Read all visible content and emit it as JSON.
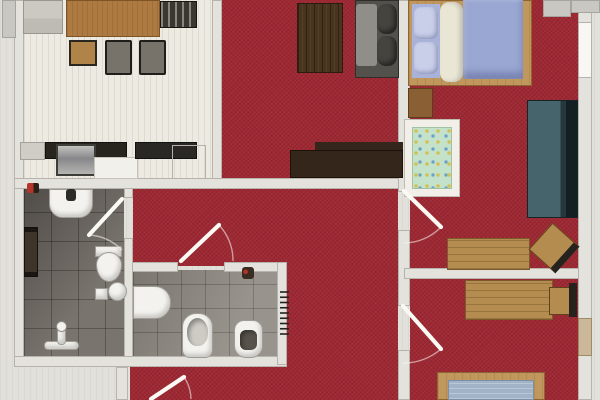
{
  "title": "apartment-floor-plan",
  "palette": {
    "carpet_red": "#9d2732",
    "floor_light": "#edeae2",
    "tile_dark": "#6f6963",
    "tile_light": "#8f8a82",
    "wall": "#e4e2dd",
    "wood": "#b58c50",
    "wood_dark": "#49341d",
    "sideboard_brown": "#34261a",
    "lavender": "#9aa7d3",
    "teal_bed": "#46646c",
    "crib_mint": "#c4e2c9",
    "mattress_blue": "#a2b3c7",
    "fixture_white": "#f3f2ee",
    "door_leaf": "#fbf9f4",
    "radiator_black": "#23211c"
  },
  "elements": [
    {
      "n": "dining-kitchen-floor",
      "c": "floor-light",
      "x": 24,
      "y": 0,
      "w": 188,
      "h": 182
    },
    {
      "n": "living-room-floor",
      "c": "carpet",
      "x": 222,
      "y": 0,
      "w": 176,
      "h": 180
    },
    {
      "n": "bedroom1-floor",
      "c": "carpet",
      "x": 410,
      "y": 0,
      "w": 168,
      "h": 272
    },
    {
      "n": "bedroom2-floor",
      "c": "carpet",
      "x": 410,
      "y": 278,
      "w": 168,
      "h": 122
    },
    {
      "n": "hallway-floor-top",
      "c": "carpet",
      "x": 133,
      "y": 188,
      "w": 265,
      "h": 78
    },
    {
      "n": "hallway-floor-right",
      "c": "carpet",
      "x": 287,
      "y": 264,
      "w": 111,
      "h": 136
    },
    {
      "n": "hallway-floor-bottom",
      "c": "carpet",
      "x": 130,
      "y": 362,
      "w": 157,
      "h": 38
    },
    {
      "n": "bathroom-floor",
      "c": "tile-dark",
      "x": 24,
      "y": 188,
      "w": 100,
      "h": 170
    },
    {
      "n": "wc-floor",
      "c": "tile-light",
      "x": 133,
      "y": 270,
      "w": 144,
      "h": 87
    },
    {
      "n": "left-exterior-wall",
      "c": "wall",
      "x": 14,
      "y": 0,
      "w": 10,
      "h": 358
    },
    {
      "n": "dining-living-wall",
      "c": "wall",
      "x": 212,
      "y": 0,
      "w": 10,
      "h": 188
    },
    {
      "n": "south-wall-band",
      "c": "wall",
      "x": 14,
      "y": 178,
      "w": 390,
      "h": 11
    },
    {
      "n": "living-bedroom1-wall",
      "c": "wall",
      "x": 398,
      "y": 0,
      "w": 12,
      "h": 192
    },
    {
      "n": "hallway-east-wall-mid",
      "c": "wall",
      "x": 398,
      "y": 230,
      "w": 12,
      "h": 76
    },
    {
      "n": "hallway-east-wall-low",
      "c": "wall",
      "x": 398,
      "y": 350,
      "w": 12,
      "h": 50
    },
    {
      "n": "bedroom-divider-wall",
      "c": "wall",
      "x": 404,
      "y": 268,
      "w": 188,
      "h": 11
    },
    {
      "n": "wc-north-wall-left",
      "c": "wall",
      "x": 124,
      "y": 262,
      "w": 54,
      "h": 10
    },
    {
      "n": "wc-north-wall-right",
      "c": "wall",
      "x": 224,
      "y": 262,
      "w": 63,
      "h": 10
    },
    {
      "n": "bathroom-east-wall-top",
      "c": "wall",
      "x": 124,
      "y": 188,
      "w": 9,
      "h": 10
    },
    {
      "n": "bathroom-east-wall-low",
      "c": "wall",
      "x": 124,
      "y": 238,
      "w": 9,
      "h": 119
    },
    {
      "n": "bath-wc-south-wall",
      "c": "wall",
      "x": 14,
      "y": 356,
      "w": 273,
      "h": 11
    },
    {
      "n": "entrance-wall",
      "c": "wall",
      "x": 116,
      "y": 367,
      "w": 12,
      "h": 33
    },
    {
      "n": "wc-east-wall",
      "c": "wall",
      "x": 277,
      "y": 262,
      "w": 10,
      "h": 103
    },
    {
      "n": "right-exterior-wall",
      "c": "wall",
      "x": 578,
      "y": 0,
      "w": 14,
      "h": 400
    },
    {
      "n": "right-wall-window",
      "c": "wall-window",
      "x": 578,
      "y": 22,
      "w": 14,
      "h": 56
    },
    {
      "n": "right-wall-wood-door",
      "c": "",
      "x": 578,
      "y": 318,
      "w": 14,
      "h": 38,
      "s": "background:#cbb89a;border:1px solid #a08a64;"
    },
    {
      "n": "balcony-slab-a",
      "c": "slab",
      "x": 543,
      "y": 0,
      "w": 28,
      "h": 17
    },
    {
      "n": "balcony-slab-b",
      "c": "slab",
      "x": 571,
      "y": 0,
      "w": 29,
      "h": 13
    },
    {
      "n": "left-edge-pillar",
      "c": "slab",
      "x": 2,
      "y": 0,
      "w": 14,
      "h": 38
    },
    {
      "n": "gray-cabinet",
      "c": "",
      "x": 23,
      "y": 0,
      "w": 40,
      "h": 34,
      "s": "background:linear-gradient(180deg,#cbc9c2 0 55%,#bdbbb4 55% 100%);border:1px solid #98968f;"
    },
    {
      "n": "dining-table",
      "c": "",
      "x": 66,
      "y": 0,
      "w": 94,
      "h": 37,
      "s": "background-color:#ad7a42;background-image:repeating-linear-gradient(90deg,rgba(120,75,25,.25) 0 1px,transparent 1px 5px);border:1px solid #7e5426;"
    },
    {
      "n": "dining-chair-top",
      "c": "",
      "x": 160,
      "y": 1,
      "w": 37,
      "h": 27,
      "s": "background-color:#3a3731;background-image:repeating-linear-gradient(90deg,rgba(230,228,220,.45) 0 2px,transparent 2px 7px);border:1px solid #17150f;"
    },
    {
      "n": "dining-chair-left",
      "c": "",
      "x": 69,
      "y": 40,
      "w": 28,
      "h": 26,
      "s": "background:#b08448;border:2px solid #2a2620;"
    },
    {
      "n": "dining-chair-mid",
      "c": "",
      "x": 105,
      "y": 40,
      "w": 27,
      "h": 35,
      "s": "background:#77726a;border:2px solid #201e19;border-radius:2px;"
    },
    {
      "n": "dining-chair-right",
      "c": "",
      "x": 139,
      "y": 40,
      "w": 27,
      "h": 35,
      "s": "background:#77726a;border:2px solid #201e19;border-radius:2px;"
    },
    {
      "n": "counter-cabinet-left",
      "c": "",
      "x": 20,
      "y": 142,
      "w": 25,
      "h": 18,
      "s": "background:#cfcdc6;border:1px solid #a3a19a;"
    },
    {
      "n": "counter-dark-left",
      "c": "",
      "x": 45,
      "y": 142,
      "w": 82,
      "h": 17,
      "s": "background:#28251f;border:1px solid #111;"
    },
    {
      "n": "kitchen-sink",
      "c": "",
      "x": 56,
      "y": 144,
      "w": 40,
      "h": 32,
      "s": "background:linear-gradient(180deg,#c2c2bf,#87878a 45%,#b5b5b2);border:2px solid #3f3d38;"
    },
    {
      "n": "counter-white-cabinet",
      "c": "",
      "x": 94,
      "y": 157,
      "w": 44,
      "h": 22,
      "s": "background:#f2f0ea;border:1px solid #c5c3bc;"
    },
    {
      "n": "counter-dark-right",
      "c": "",
      "x": 135,
      "y": 142,
      "w": 62,
      "h": 17,
      "s": "background:#2a2824;border:1px solid #111;"
    },
    {
      "n": "appliance-outline",
      "c": "",
      "x": 172,
      "y": 145,
      "w": 34,
      "h": 34,
      "s": "border:1px solid #b4b2aa;"
    },
    {
      "n": "red-object-kitchen",
      "c": "",
      "x": 27,
      "y": 183,
      "w": 12,
      "h": 10,
      "s": "background:linear-gradient(90deg,#b5342a 0 55%,#2b2017 55% 100%);border-radius:2px;"
    },
    {
      "n": "coffee-table",
      "c": "",
      "x": 297,
      "y": 3,
      "w": 46,
      "h": 70,
      "s": "background-color:#49341d;background-image:repeating-linear-gradient(90deg,rgba(0,0,0,.35) 0 1px,transparent 1px 4px,rgba(255,255,255,.06) 4px 5px,transparent 5px 8px);border:1px solid #2a1c0e;"
    },
    {
      "n": "sofa-base",
      "c": "",
      "x": 355,
      "y": 0,
      "w": 44,
      "h": 78,
      "s": "background:#52514c;border:1px solid #2e2d29;"
    },
    {
      "n": "sofa-seats",
      "c": "",
      "x": 356,
      "y": 4,
      "w": 21,
      "h": 62,
      "s": "background:#8f8e89;border-radius:3px;"
    },
    {
      "n": "sofa-back-cushion-a",
      "c": "",
      "x": 377,
      "y": 4,
      "w": 20,
      "h": 30,
      "s": "background:#45443f;border-radius:9px;box-shadow:inset -3px -3px 5px rgba(0,0,0,.45);"
    },
    {
      "n": "sofa-back-cushion-b",
      "c": "",
      "x": 377,
      "y": 36,
      "w": 20,
      "h": 30,
      "s": "background:#45443f;border-radius:9px;box-shadow:inset -3px -3px 5px rgba(0,0,0,.45);"
    },
    {
      "n": "tv-sideboard-step",
      "c": "",
      "x": 315,
      "y": 142,
      "w": 88,
      "h": 10,
      "s": "background:#34261a;"
    },
    {
      "n": "tv-sideboard",
      "c": "",
      "x": 290,
      "y": 150,
      "w": 113,
      "h": 28,
      "s": "background:#34261a;border:1px solid #1c1209;"
    },
    {
      "n": "bed1-frame",
      "c": "wood-mid",
      "x": 408,
      "y": 0,
      "w": 124,
      "h": 86
    },
    {
      "n": "bed1-pillow-zone",
      "c": "",
      "x": 412,
      "y": 4,
      "w": 28,
      "h": 74,
      "s": "background:#a9b3d9;"
    },
    {
      "n": "bed1-pillow-a",
      "c": "",
      "x": 414,
      "y": 7,
      "w": 24,
      "h": 32,
      "s": "background:#c9cfe9;border-radius:7px;box-shadow:inset -2px -2px 4px rgba(60,70,120,.4);"
    },
    {
      "n": "bed1-pillow-b",
      "c": "",
      "x": 414,
      "y": 42,
      "w": 24,
      "h": 32,
      "s": "background:#c9cfe9;border-radius:7px;box-shadow:inset -2px -2px 4px rgba(60,70,120,.4);"
    },
    {
      "n": "bed1-blanket-roll",
      "c": "",
      "x": 440,
      "y": 2,
      "w": 23,
      "h": 80,
      "s": "background:#eae6d5;border-radius:9px;box-shadow:inset -3px 0 5px rgba(0,0,0,.18);"
    },
    {
      "n": "bed1-duvet",
      "c": "",
      "x": 463,
      "y": 0,
      "w": 60,
      "h": 79,
      "s": "background:#9aa7d3;box-shadow:inset 0 -6px 8px rgba(40,50,100,.35),inset 3px 0 4px rgba(255,255,255,.35);"
    },
    {
      "n": "nightstand",
      "c": "",
      "x": 408,
      "y": 88,
      "w": 25,
      "h": 30,
      "s": "background:#8a5f34;border:1px solid #5e3d1d;"
    },
    {
      "n": "crib-frame",
      "c": "",
      "x": 404,
      "y": 119,
      "w": 56,
      "h": 78,
      "s": "background:#f1efe8;border:1px solid #bdbbb2;"
    },
    {
      "n": "crib-mattress",
      "c": "",
      "x": 412,
      "y": 127,
      "w": 40,
      "h": 62,
      "s": "background-color:#c4e2c9;background-image:radial-gradient(circle at 3px 3px,rgba(215,185,60,.85) 1.3px,transparent 2.2px),radial-gradient(circle at 7px 8px,rgba(80,140,200,.75) 1.2px,transparent 2.2px);background-size:11px 11px,13px 13px;border:1px solid #9fc2a6;"
    },
    {
      "n": "teal-daybed",
      "c": "",
      "x": 527,
      "y": 100,
      "w": 51,
      "h": 118,
      "s": "background:linear-gradient(90deg,#46646c 0 66%,#25383d 66% 78%,#131f22 78% 100%);border:1px solid #16242a;"
    },
    {
      "n": "desk1",
      "c": "wood-desk",
      "x": 447,
      "y": 238,
      "w": 83,
      "h": 32
    },
    {
      "n": "desk1-chair",
      "c": "",
      "x": 536,
      "y": 230,
      "w": 36,
      "h": 36,
      "s": "background:#b58c50;border:1px solid #5f4218;border-right:7px solid #26231e;transform:rotate(42deg);"
    },
    {
      "n": "desk2",
      "c": "wood-desk",
      "x": 465,
      "y": 280,
      "w": 88,
      "h": 40
    },
    {
      "n": "desk2-chair-seat",
      "c": "",
      "x": 549,
      "y": 287,
      "w": 24,
      "h": 28,
      "s": "background:#b58c50;border:1px solid #5f4218;"
    },
    {
      "n": "desk2-chair-back",
      "c": "",
      "x": 569,
      "y": 283,
      "w": 8,
      "h": 34,
      "s": "background:#26231e;"
    },
    {
      "n": "bed2-frame",
      "c": "wood-mid",
      "x": 437,
      "y": 372,
      "w": 108,
      "h": 28
    },
    {
      "n": "bed2-mattress",
      "c": "",
      "x": 448,
      "y": 380,
      "w": 86,
      "h": 20,
      "s": "background-color:#a2b3c7;background-image:repeating-linear-gradient(0deg,rgba(255,255,255,.25) 0 1px,transparent 1px 5px);border:1px solid #7c8fa5;"
    },
    {
      "n": "bathroom-sink",
      "c": "white-fixture",
      "x": 49,
      "y": 189,
      "w": 44,
      "h": 29,
      "s": "border-radius:0 0 14px 14px;"
    },
    {
      "n": "bathroom-sink-faucet",
      "c": "",
      "x": 66,
      "y": 189,
      "w": 10,
      "h": 12,
      "s": "background:#2b2b28;border-radius:3px;"
    },
    {
      "n": "towel-radiator",
      "c": "",
      "x": 24,
      "y": 227,
      "w": 14,
      "h": 50,
      "s": "background:#3f342a;border:1px solid #140f0a;box-shadow:inset 0 4px 0 #1c1510,inset 0 -4px 0 #1c1510;"
    },
    {
      "n": "toilet1-tank",
      "c": "white-fixture",
      "x": 95,
      "y": 246,
      "w": 27,
      "h": 11
    },
    {
      "n": "toilet1-bowl",
      "c": "white-fixture",
      "x": 96,
      "y": 252,
      "w": 26,
      "h": 30,
      "s": "border-radius:50% 50% 50% 50% / 42% 42% 58% 58%;"
    },
    {
      "n": "bathroom-small-box",
      "c": "white-fixture",
      "x": 95,
      "y": 288,
      "w": 13,
      "h": 12
    },
    {
      "n": "bathroom-stool",
      "c": "white-fixture",
      "x": 108,
      "y": 282,
      "w": 19,
      "h": 19,
      "s": "border-radius:50%;"
    },
    {
      "n": "shower-bar-horizontal",
      "c": "white-fixture",
      "x": 44,
      "y": 341,
      "w": 35,
      "h": 9,
      "s": "border-radius:4px;"
    },
    {
      "n": "shower-bar-vertical",
      "c": "white-fixture",
      "x": 57,
      "y": 327,
      "w": 9,
      "h": 18,
      "s": "border-radius:4px;"
    },
    {
      "n": "shower-head-knob",
      "c": "",
      "x": 56,
      "y": 321,
      "w": 11,
      "h": 11,
      "s": "background:#f3f2ee;border:1px solid #8e8c85;border-radius:50%;"
    },
    {
      "n": "wc-basin",
      "c": "white-fixture",
      "x": 133,
      "y": 286,
      "w": 38,
      "h": 33,
      "s": "border-radius:0 16px 16px 0;"
    },
    {
      "n": "wc-bidet",
      "c": "white-fixture",
      "x": 182,
      "y": 313,
      "w": 31,
      "h": 45,
      "s": "border-radius:14px 14px 8px 8px;"
    },
    {
      "n": "wc-bidet-bowl",
      "c": "",
      "x": 187,
      "y": 318,
      "w": 21,
      "h": 28,
      "s": "background:#cdcbc4;border-radius:50% 50% 45% 45%;box-shadow:inset 2px 3px 5px rgba(0,0,0,.35);"
    },
    {
      "n": "wc-toilet",
      "c": "white-fixture",
      "x": 234,
      "y": 320,
      "w": 29,
      "h": 38,
      "s": "border-radius:10px 10px 12px 12px;"
    },
    {
      "n": "wc-toilet-opening",
      "c": "",
      "x": 240,
      "y": 330,
      "w": 17,
      "h": 20,
      "s": "background:#57534b;border-radius:6px;box-shadow:inset 2px 2px 4px rgba(0,0,0,.4);"
    },
    {
      "n": "wc-small-object",
      "c": "",
      "x": 242,
      "y": 267,
      "w": 12,
      "h": 12,
      "s": "background:radial-gradient(circle at 30% 40%,#b5342a 2px,#3a2c20 2.5px);border-radius:3px;"
    }
  ],
  "overlay": {
    "doors": [
      {
        "n": "bathroom-door",
        "leaf": [
          122,
          199,
          89,
          235
        ],
        "arc": "M 89 235 A 51 51 0 0 1 122 250"
      },
      {
        "n": "wc-door",
        "leaf": [
          181,
          261,
          219,
          225
        ],
        "arc": "M 219 225 A 52 52 0 0 1 233 261"
      },
      {
        "n": "bedroom1-door",
        "leaf": [
          404,
          191,
          441,
          227
        ],
        "arc": "M 441 227 A 52 52 0 0 1 404 243"
      },
      {
        "n": "bedroom2-door",
        "leaf": [
          403,
          306,
          441,
          349
        ],
        "arc": "M 441 349 A 57 57 0 0 1 403 363"
      },
      {
        "n": "entrance-door",
        "leaf": [
          151,
          399,
          184,
          377
        ],
        "arc": "M 184 377 A 40 40 0 0 1 191 399"
      }
    ],
    "radiator": {
      "n": "hallway-radiator",
      "x1": 280,
      "x2": 289,
      "y_start": 292,
      "y_end": 334,
      "ticks": 9
    }
  }
}
